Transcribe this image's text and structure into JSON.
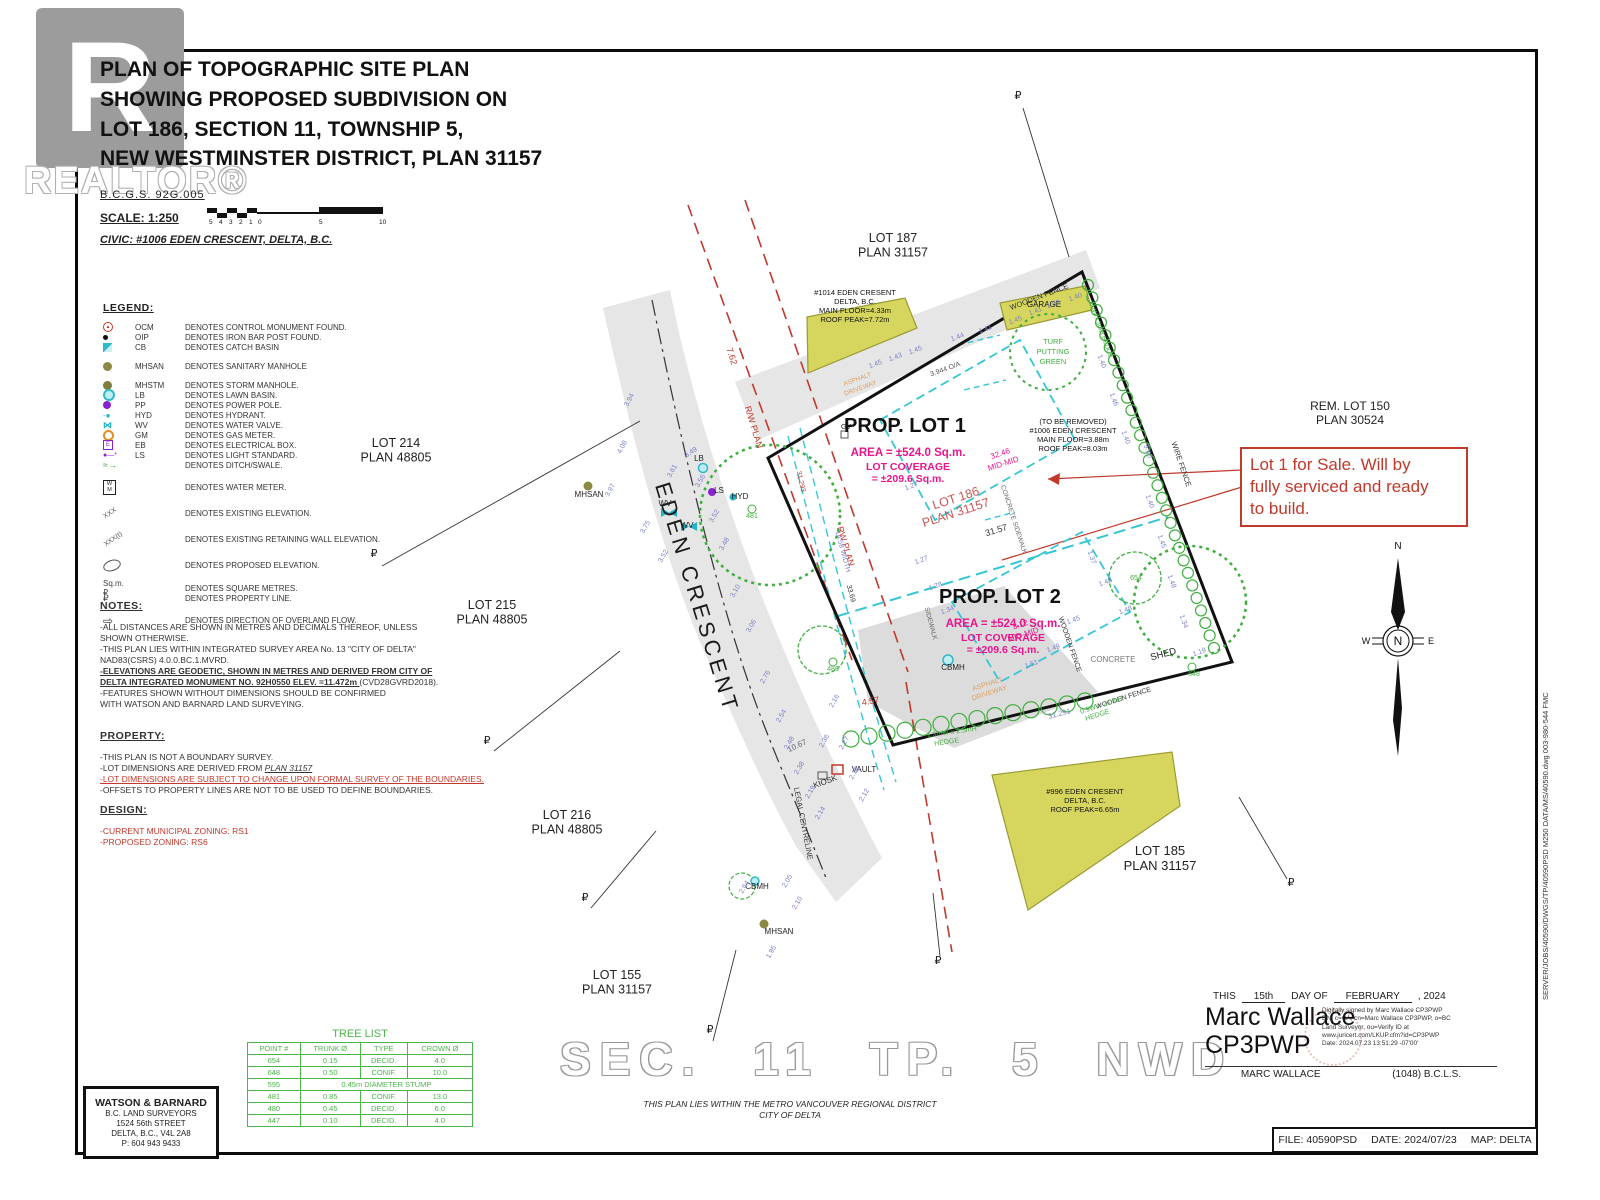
{
  "colors": {
    "red": "#c0392b",
    "magenta": "#e8158c",
    "green": "#3fae3f",
    "cyan": "#35c6d6",
    "blue": "#7b82c8",
    "orange": "#dfa05f",
    "yellow": "#d6d65e",
    "road": "#e6e6e6"
  },
  "title_block": {
    "title_lines": [
      "PLAN OF TOPOGRAPHIC SITE PLAN",
      "SHOWING PROPOSED SUBDIVISION ON",
      "LOT 186, SECTION 11, TOWNSHIP 5,",
      "NEW WESTMINSTER DISTRICT, PLAN 31157"
    ],
    "bcgs": "B.C.G.S.  92G.005",
    "scale_label": "SCALE:   1:250",
    "scale_numbers": [
      "5",
      "4",
      "3",
      "2",
      "1",
      "0",
      "5",
      "10"
    ],
    "civic": "CIVIC: #1006 EDEN CRESCENT, DELTA, B.C."
  },
  "watermark": {
    "letter": "R",
    "word": "REALTOR®"
  },
  "legend": {
    "heading": "LEGEND:",
    "items": [
      {
        "sym": "ocm",
        "code": "OCM",
        "desc": "DENOTES CONTROL MONUMENT FOUND."
      },
      {
        "sym": "oip",
        "code": "OIP",
        "desc": "DENOTES IRON BAR POST FOUND."
      },
      {
        "sym": "cb",
        "code": "CB",
        "desc": "DENOTES CATCH BASIN"
      },
      {
        "sym": "mhsan",
        "code": "MHSAN",
        "desc": "DENOTES SANITARY MANHOLE",
        "gap": true
      },
      {
        "sym": "mhstm",
        "code": "MHSTM",
        "desc": "DENOTES STORM MANHOLE.",
        "gap": true
      },
      {
        "sym": "lb",
        "code": "LB",
        "desc": "DENOTES LAWN BASIN."
      },
      {
        "sym": "pp",
        "code": "PP",
        "desc": "DENOTES POWER POLE."
      },
      {
        "sym": "hyd",
        "code": "HYD",
        "desc": "DENOTES HYDRANT."
      },
      {
        "sym": "wv",
        "code": "WV",
        "desc": "DENOTES WATER VALVE."
      },
      {
        "sym": "gm",
        "code": "GM",
        "desc": "DENOTES GAS METER."
      },
      {
        "sym": "eb",
        "code": "EB",
        "desc": "DENOTES ELECTRICAL BOX."
      },
      {
        "sym": "ls",
        "code": "LS",
        "desc": "DENOTES LIGHT STANDARD."
      },
      {
        "sym": "ditch",
        "code": "",
        "desc": "DENOTES DITCH/SWALE."
      },
      {
        "sym": "wm",
        "code": "",
        "desc": "DENOTES WATER METER.",
        "gap": true,
        "tall": true
      },
      {
        "sym": "xxx",
        "code": "",
        "desc": "DENOTES EXISTING ELEVATION.",
        "gap": true,
        "tall": true
      },
      {
        "sym": "xxxt",
        "code": "",
        "desc": "DENOTES EXISTING RETAINING WALL ELEVATION.",
        "gap": true,
        "tall": true
      },
      {
        "sym": "oval",
        "code": "",
        "desc": "DENOTES PROPOSED ELEVATION.",
        "gap": true,
        "tall": true
      },
      {
        "sym": "sqm",
        "code": "",
        "desc": "DENOTES SQUARE METRES.",
        "gap": true
      },
      {
        "sym": "pl",
        "code": "",
        "desc": "DENOTES PROPERTY LINE."
      },
      {
        "sym": "arrow",
        "code": "",
        "desc": "DENOTES DIRECTION OF OVERLAND FLOW.",
        "gap": true,
        "tall": true
      }
    ]
  },
  "notes": {
    "heading": "NOTES:",
    "lines": [
      {
        "t": "-ALL DISTANCES ARE SHOWN IN METRES AND DECIMALS THEREOF, UNLESS"
      },
      {
        "t": " SHOWN OTHERWISE."
      },
      {
        "t": "-THIS PLAN LIES WITHIN INTEGRATED SURVEY AREA No. 13 \"CITY OF DELTA\""
      },
      {
        "t": " NAD83(CSRS) 4.0.0.BC.1.MVRD."
      },
      {
        "t": "-ELEVATIONS ARE GEODETIC, SHOWN IN METRES AND DERIVED FROM CITY OF",
        "style": "bold"
      },
      {
        "t": " DELTA INTEGRATED MONUMENT NO. 92H0550 ELEV. =11.472m ",
        "style": "bold",
        "t2": "(CVD28GVRD2018)."
      },
      {
        "t": "-FEATURES SHOWN WITHOUT DIMENSIONS SHOULD BE CONFIRMED"
      },
      {
        "t": " WITH WATSON AND BARNARD LAND SURVEYING."
      }
    ]
  },
  "property": {
    "heading": "PROPERTY:",
    "lines": [
      {
        "t": "-THIS PLAN IS NOT A BOUNDARY SURVEY."
      },
      {
        "t": "-LOT DIMENSIONS ARE DERIVED FROM ",
        "t2": "PLAN 31157",
        "style2": "italic-underline"
      },
      {
        "t": "-LOT DIMENSIONS ARE SUBJECT TO CHANGE UPON FORMAL SURVEY OF THE BOUNDARIES.",
        "style": "red-underline"
      },
      {
        "t": "-OFFSETS TO PROPERTY LINES ARE NOT TO BE USED TO DEFINE  BOUNDARIES."
      }
    ]
  },
  "design": {
    "heading": "DESIGN:",
    "lines": [
      {
        "t": "-CURRENT MUNICIPAL ZONING: RS1",
        "style": "red"
      },
      {
        "t": "-PROPOSED ZONING: RS6",
        "style": "red"
      }
    ]
  },
  "sale_note": {
    "lines": [
      "Lot 1 for Sale. Will by",
      "fully serviced and ready",
      "to build."
    ]
  },
  "lot_labels": [
    {
      "l1": "LOT 214",
      "l2": "PLAN 48805",
      "x": 396,
      "y": 447,
      "s": 12.5,
      "c": "#222"
    },
    {
      "l1": "LOT 215",
      "l2": "PLAN 48805",
      "x": 492,
      "y": 609,
      "s": 12.5,
      "c": "#222"
    },
    {
      "l1": "LOT 216",
      "l2": "PLAN 48805",
      "x": 567,
      "y": 819,
      "s": 12.5,
      "c": "#222"
    },
    {
      "l1": "LOT 155",
      "l2": "PLAN 31157",
      "x": 617,
      "y": 979,
      "s": 12.5,
      "c": "#222"
    },
    {
      "l1": "LOT 187",
      "l2": "PLAN 31157",
      "x": 893,
      "y": 242,
      "s": 12.5,
      "c": "#222"
    },
    {
      "l1": "REM. LOT 150",
      "l2": "PLAN 30524",
      "x": 1350,
      "y": 410,
      "s": 12,
      "c": "#222"
    },
    {
      "l1": "LOT 185",
      "l2": "PLAN 31157",
      "x": 1160,
      "y": 855,
      "s": 13,
      "c": "#222"
    },
    {
      "l1": "LOT 186",
      "l2": "PLAN 31157",
      "x": 957,
      "y": 502,
      "s": 12.5,
      "c": "#cc5555",
      "r": -18
    }
  ],
  "prop_lots": [
    {
      "name": "PROP. LOT 1",
      "area": "AREA =  ±524.0 Sq.m.",
      "cov1": "LOT COVERAGE",
      "cov2": "= ±209.6 Sq.m.",
      "x": 905,
      "y": 432
    },
    {
      "name": "PROP. LOT 2",
      "area": "AREA =  ±524.0 Sq.m.",
      "cov1": "LOT COVERAGE",
      "cov2": "= ±209.6 Sq.m.",
      "x": 1000,
      "y": 603
    }
  ],
  "plan_labels": [
    {
      "t": "EDEN CRESCENT",
      "x": 690,
      "y": 600,
      "r": 73,
      "s": 22,
      "c": "#1a1a1a",
      "ls": 4
    },
    {
      "t": "R/W PLAN",
      "x": 751,
      "y": 428,
      "r": 73,
      "s": 9,
      "c": "red"
    },
    {
      "t": "RW PLAN",
      "x": 843,
      "y": 547,
      "r": 73,
      "s": 9,
      "c": "red"
    },
    {
      "t": "7.62",
      "x": 729,
      "y": 357,
      "r": 73,
      "s": 9,
      "c": "red"
    },
    {
      "t": "4.57",
      "x": 871,
      "y": 704,
      "r": -10,
      "s": 9,
      "c": "red"
    },
    {
      "t": "31.293",
      "x": 799,
      "y": 482,
      "r": 77,
      "s": 7,
      "c": "red"
    },
    {
      "t": "31.57",
      "x": 997,
      "y": 533,
      "r": -17,
      "s": 9,
      "c": "#333"
    },
    {
      "t": "31.291",
      "x": 1060,
      "y": 716,
      "r": -15,
      "s": 7.5,
      "c": "blue"
    },
    {
      "t": "33.69",
      "x": 849,
      "y": 594,
      "r": 75,
      "s": 7,
      "c": "#333"
    },
    {
      "t": "3.944 O/A",
      "x": 946,
      "y": 371,
      "r": -20,
      "s": 7,
      "c": "#555"
    },
    {
      "t": "14.58 WIDTH",
      "x": 841,
      "y": 552,
      "r": 75,
      "s": 7,
      "c": "blue"
    },
    {
      "t": "WOODEN FENCE",
      "x": 1040,
      "y": 299,
      "r": -21,
      "s": 7.5,
      "c": "#333"
    },
    {
      "t": "WIRE FENCE",
      "x": 1179,
      "y": 465,
      "r": 71,
      "s": 7.5,
      "c": "#333"
    },
    {
      "t": "WOODEN FENCE",
      "x": 1068,
      "y": 645,
      "r": 71,
      "s": 7,
      "c": "#333"
    },
    {
      "t": "WOODEN FENCE",
      "x": 1124,
      "y": 700,
      "r": -18,
      "s": 7,
      "c": "#333"
    },
    {
      "t": "CONCRETE",
      "x": 1113,
      "y": 662,
      "r": 0,
      "s": 8,
      "c": "#777"
    },
    {
      "t": "SHED",
      "x": 1164,
      "y": 657,
      "r": -15,
      "s": 9.5,
      "c": "#222"
    },
    {
      "t": "CONCRETE SIDEWALK",
      "x": 1012,
      "y": 520,
      "r": 72,
      "s": 6.5,
      "c": "#666"
    },
    {
      "t": "SIDEWALK",
      "x": 929,
      "y": 624,
      "r": 75,
      "s": 6.5,
      "c": "#666"
    },
    {
      "t": "LEGAL CENTRELINE",
      "x": 801,
      "y": 824,
      "r": 79,
      "s": 7.5,
      "c": "#333"
    },
    {
      "t": "10.67",
      "x": 798,
      "y": 748,
      "r": -25,
      "s": 8,
      "c": "#667"
    },
    {
      "t": "1.3mW x 2.5mH",
      "x": 952,
      "y": 734,
      "r": -8,
      "s": 7,
      "c": "green"
    },
    {
      "t": "HEDGE",
      "x": 947,
      "y": 744,
      "r": -8,
      "s": 7,
      "c": "green"
    },
    {
      "t": "0.9W x 2.0mH",
      "x": 1102,
      "y": 707,
      "r": -18,
      "s": 7,
      "c": "green"
    },
    {
      "t": "HEDGE",
      "x": 1098,
      "y": 717,
      "r": -18,
      "s": 7,
      "c": "green"
    },
    {
      "t": "3mW x 3mH HEDGE",
      "x": 1099,
      "y": 330,
      "r": 70,
      "s": 6.5,
      "c": "green"
    },
    {
      "t": "TURF",
      "x": 1053,
      "y": 344,
      "r": 0,
      "s": 7.5,
      "c": "green"
    },
    {
      "t": "PUTTING",
      "x": 1053,
      "y": 354,
      "r": 0,
      "s": 7.5,
      "c": "green"
    },
    {
      "t": "GREEN",
      "x": 1053,
      "y": 364,
      "r": 0,
      "s": 7.5,
      "c": "green"
    },
    {
      "t": "CBMH",
      "x": 953,
      "y": 670,
      "r": 0,
      "s": 8,
      "c": "#222"
    },
    {
      "t": "CBMH",
      "x": 757,
      "y": 889,
      "r": 0,
      "s": 8,
      "c": "#222"
    },
    {
      "t": "MHSAN",
      "x": 779,
      "y": 934,
      "r": 0,
      "s": 8,
      "c": "#222"
    },
    {
      "t": "MHSAN",
      "x": 589,
      "y": 497,
      "r": 0,
      "s": 8,
      "c": "#222"
    },
    {
      "t": "LB",
      "x": 699,
      "y": 461,
      "r": 0,
      "s": 8,
      "c": "#222"
    },
    {
      "t": "LS",
      "x": 719,
      "y": 493,
      "r": 0,
      "s": 8,
      "c": "#222"
    },
    {
      "t": "HYD",
      "x": 740,
      "y": 499,
      "r": 0,
      "s": 8,
      "c": "#222"
    },
    {
      "t": "WV",
      "x": 665,
      "y": 506,
      "r": 0,
      "s": 8,
      "c": "#222"
    },
    {
      "t": "WV",
      "x": 687,
      "y": 528,
      "r": 0,
      "s": 8,
      "c": "#222"
    },
    {
      "t": "GV",
      "x": 846,
      "y": 429,
      "r": 0,
      "s": 7,
      "c": "#222"
    },
    {
      "t": "KIOSK",
      "x": 826,
      "y": 784,
      "r": -20,
      "s": 8,
      "c": "#222"
    },
    {
      "t": "VAULT",
      "x": 864,
      "y": 772,
      "r": 0,
      "s": 8,
      "c": "#222"
    },
    {
      "t": "ASPHALT",
      "x": 988,
      "y": 686,
      "r": -18,
      "s": 7,
      "c": "orange"
    },
    {
      "t": "DRIVEWAY",
      "x": 990,
      "y": 695,
      "r": -18,
      "s": 7,
      "c": "orange"
    },
    {
      "t": "ASPHALT",
      "x": 858,
      "y": 381,
      "r": -20,
      "s": 6.5,
      "c": "orange"
    },
    {
      "t": "DRIVEWAY",
      "x": 861,
      "y": 390,
      "r": -20,
      "s": 6.5,
      "c": "orange"
    },
    {
      "t": "3.12",
      "x": 1021,
      "y": 627,
      "r": -18,
      "s": 8,
      "c": "magenta"
    },
    {
      "t": "MID-MID",
      "x": 1024,
      "y": 637,
      "r": -18,
      "s": 8,
      "c": "magenta"
    },
    {
      "t": "32.46",
      "x": 1001,
      "y": 456,
      "r": -18,
      "s": 8,
      "c": "magenta"
    },
    {
      "t": "MID-MID",
      "x": 1004,
      "y": 466,
      "r": -18,
      "s": 8,
      "c": "magenta"
    },
    {
      "t": "(TO BE REMOVED)",
      "x": 1073,
      "y": 424,
      "r": 0,
      "s": 7.5,
      "c": "#111"
    },
    {
      "t": "#1006 EDEN CRESCENT",
      "x": 1073,
      "y": 433,
      "r": 0,
      "s": 7.5,
      "c": "#111"
    },
    {
      "t": "MAIN FLOOR=3.88m",
      "x": 1073,
      "y": 442,
      "r": 0,
      "s": 7.5,
      "c": "#111"
    },
    {
      "t": "ROOF PEAK=8.03m",
      "x": 1073,
      "y": 451,
      "r": 0,
      "s": 7.5,
      "c": "#111"
    },
    {
      "t": "#1014 EDEN CRESENT",
      "x": 855,
      "y": 295,
      "r": 0,
      "s": 7.5,
      "c": "#111"
    },
    {
      "t": "DELTA, B.C.",
      "x": 855,
      "y": 304,
      "r": 0,
      "s": 7.5,
      "c": "#111"
    },
    {
      "t": "MAIN FLOOR=4.33m",
      "x": 855,
      "y": 313,
      "r": 0,
      "s": 7.5,
      "c": "#111"
    },
    {
      "t": "ROOF PEAK=7.72m",
      "x": 855,
      "y": 322,
      "r": 0,
      "s": 7.5,
      "c": "#111"
    },
    {
      "t": "GARAGE",
      "x": 1044,
      "y": 307,
      "r": 0,
      "s": 8,
      "c": "#111"
    },
    {
      "t": "#996 EDEN CRESENT",
      "x": 1085,
      "y": 794,
      "r": 0,
      "s": 7.5,
      "c": "#111"
    },
    {
      "t": "DELTA, B.C.",
      "x": 1085,
      "y": 803,
      "r": 0,
      "s": 7.5,
      "c": "#111"
    },
    {
      "t": "ROOF PEAK=6.65m",
      "x": 1085,
      "y": 812,
      "r": 0,
      "s": 7.5,
      "c": "#111"
    },
    {
      "t": "654",
      "x": 1136,
      "y": 580,
      "r": 0,
      "s": 7,
      "c": "green"
    },
    {
      "t": "648",
      "x": 1194,
      "y": 676,
      "r": 0,
      "s": 7,
      "c": "green"
    },
    {
      "t": "481",
      "x": 752,
      "y": 518,
      "r": 0,
      "s": 7,
      "c": "green"
    },
    {
      "t": "480",
      "x": 833,
      "y": 671,
      "r": 0,
      "s": 7,
      "c": "green"
    },
    {
      "t": "9.00",
      "x": 1146,
      "y": 452,
      "r": 71,
      "s": 7,
      "c": "blue"
    },
    {
      "t": "N",
      "x": 1398,
      "y": 549,
      "r": 0,
      "s": 10,
      "c": "#111"
    },
    {
      "t": "N",
      "x": 1398,
      "y": 645,
      "r": 0,
      "s": 12,
      "c": "#111"
    },
    {
      "t": "W",
      "x": 1366,
      "y": 644,
      "r": 0,
      "s": 9,
      "c": "#111"
    },
    {
      "t": "E",
      "x": 1431,
      "y": 644,
      "r": 0,
      "s": 9,
      "c": "#111"
    }
  ],
  "elevations": [
    [
      631,
      401,
      "3.94",
      -62
    ],
    [
      624,
      448,
      "4.08",
      -62
    ],
    [
      612,
      491,
      "3.97",
      -62
    ],
    [
      647,
      528,
      "3.75",
      -60
    ],
    [
      665,
      557,
      "3.52",
      -60
    ],
    [
      674,
      472,
      "3.61",
      -60
    ],
    [
      692,
      454,
      "3.49",
      -35
    ],
    [
      702,
      482,
      "3.56",
      -60
    ],
    [
      716,
      517,
      "3.52",
      -60
    ],
    [
      726,
      545,
      "3.48",
      -60
    ],
    [
      737,
      592,
      "3.10",
      -60
    ],
    [
      753,
      627,
      "3.06",
      -60
    ],
    [
      767,
      678,
      "2.76",
      -60
    ],
    [
      783,
      717,
      "2.54",
      -60
    ],
    [
      791,
      744,
      "2.48",
      -60
    ],
    [
      801,
      769,
      "2.38",
      -60
    ],
    [
      812,
      793,
      "2.19",
      -60
    ],
    [
      822,
      814,
      "2.14",
      -60
    ],
    [
      876,
      366,
      "1.45",
      -20
    ],
    [
      896,
      359,
      "1.43",
      -20
    ],
    [
      916,
      352,
      "1.45",
      -20
    ],
    [
      958,
      339,
      "1.44",
      -20
    ],
    [
      986,
      331,
      "1.41",
      -20
    ],
    [
      1016,
      322,
      "1.45",
      -20
    ],
    [
      1036,
      313,
      "1.41",
      -20
    ],
    [
      1054,
      306,
      "1.59",
      -20
    ],
    [
      1076,
      299,
      "1.40",
      -20
    ],
    [
      1100,
      362,
      "1.40",
      70
    ],
    [
      1112,
      400,
      "1.46",
      70
    ],
    [
      1124,
      438,
      "1.40",
      70
    ],
    [
      1148,
      502,
      "1.40",
      70
    ],
    [
      1160,
      542,
      "1.45",
      70
    ],
    [
      1170,
      582,
      "1.48",
      70
    ],
    [
      1182,
      622,
      "1.34",
      70
    ],
    [
      1200,
      654,
      "1.19",
      -20
    ],
    [
      1126,
      612,
      "1.48",
      -20
    ],
    [
      1106,
      584,
      "1.43",
      -20
    ],
    [
      1090,
      558,
      "1.37",
      70
    ],
    [
      1074,
      622,
      "1.45",
      -20
    ],
    [
      1054,
      650,
      "1.49",
      -20
    ],
    [
      1032,
      666,
      "1.51",
      -20
    ],
    [
      922,
      562,
      "1.27",
      -20
    ],
    [
      936,
      588,
      "1.28",
      -20
    ],
    [
      948,
      612,
      "1.34",
      -20
    ],
    [
      912,
      488,
      "1.27",
      -20
    ],
    [
      846,
      744,
      "2.27",
      -60
    ],
    [
      856,
      774,
      "2.18",
      -60
    ],
    [
      866,
      796,
      "2.12",
      -60
    ],
    [
      789,
      882,
      "2.05",
      -60
    ],
    [
      799,
      904,
      "2.10",
      -60
    ],
    [
      773,
      953,
      "1.95",
      -60
    ],
    [
      836,
      702,
      "2.16",
      -60
    ],
    [
      826,
      742,
      "2.36",
      -60
    ],
    [
      746,
      888,
      "2.64",
      -60
    ]
  ],
  "pl_symbols": [
    [
      374,
      557
    ],
    [
      487,
      744
    ],
    [
      585,
      901
    ],
    [
      710,
      1033
    ],
    [
      1018,
      99
    ],
    [
      1291,
      886
    ],
    [
      938,
      964
    ]
  ],
  "tree_list": {
    "title": "TREE LIST",
    "headers": [
      "POINT #",
      "TRUNK Ø",
      "TYPE",
      "CROWN Ø"
    ],
    "rows": [
      [
        "654",
        "0.15",
        "DECID.",
        "4.0"
      ],
      [
        "648",
        "0.50",
        "CONIF.",
        "10.0"
      ],
      [
        "595",
        "0.45m DIAMETER STUMP"
      ],
      [
        "481",
        "0.85",
        "CONIF.",
        "13.0"
      ],
      [
        "480",
        "0.45",
        "DECID.",
        "6.0"
      ],
      [
        "447",
        "0.10",
        "DECID.",
        "4.0"
      ]
    ]
  },
  "surveyor_box": {
    "name": "WATSON & BARNARD",
    "lines": [
      "B.C. LAND SURVEYORS",
      "1524 56th STREET",
      "DELTA, B.C., V4L 2A8",
      "P: 604 943 9433"
    ]
  },
  "sec_banner": "SEC.  11    TP.  5    NWD",
  "region_note": [
    "THIS PLAN LIES WITHIN THE METRO VANCOUVER REGIONAL DISTRICT",
    "CITY OF DELTA"
  ],
  "signature": {
    "pre": "THIS",
    "day": "15th",
    "mid": "DAY OF",
    "month": "FEBRUARY",
    "year": ", 2024",
    "sig1": "Marc Wallace",
    "sig2": "CP3PWP",
    "digital": [
      "Digitally signed by Marc Wallace CP3PWP",
      "DN: c=CA, cn=Marc Wallace CP3PWP, o=BC",
      "Land Surveyor, ou=Verify ID at",
      "www.juricert.com/LKUP.cfm?id=CP3PWP",
      "Date: 2024.07.23 13:51:29 -07'00'"
    ],
    "name": "MARC WALLACE",
    "cred": "(1048) B.C.L.S."
  },
  "file_box": {
    "file": "FILE: 40590PSD",
    "date": "DATE: 2024/07/23",
    "map": "MAP: DELTA"
  },
  "side_text": "SERVER/JOBS/40590/DWGS/TP/40590PSD   M250   DATA/MS/40590.dwg   003-980-544   FMC"
}
